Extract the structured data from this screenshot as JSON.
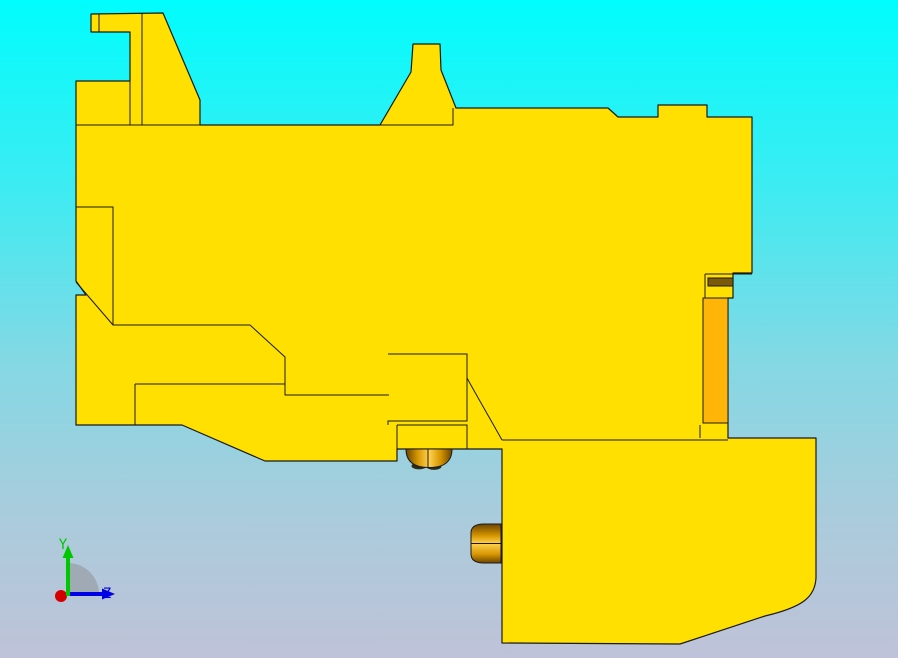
{
  "viewport": {
    "description": "CAD side-view viewport",
    "background": {
      "top": "#00fdfd",
      "upper_mid": "#3cecf2",
      "mid": "#84d8e4",
      "lower_mid": "#a9ccdc",
      "bottom": "#bfc2d8"
    },
    "part": {
      "body_color": "#ffe000",
      "outline_color": "#1a1a1a",
      "accent_orange": "#ffb408",
      "accent_brown": "#7a5a08",
      "gold_bright": "#ffd24e",
      "gold_mid": "#d69500",
      "gold_dark": "#6b4400",
      "blob_dark": "#2e2a18"
    }
  },
  "triad": {
    "y_label": "Y",
    "z_label": "Z",
    "y_color": "#00c800",
    "z_color": "#0000e6",
    "x_color": "#d40000",
    "fan_color": "#9aa2ab"
  }
}
